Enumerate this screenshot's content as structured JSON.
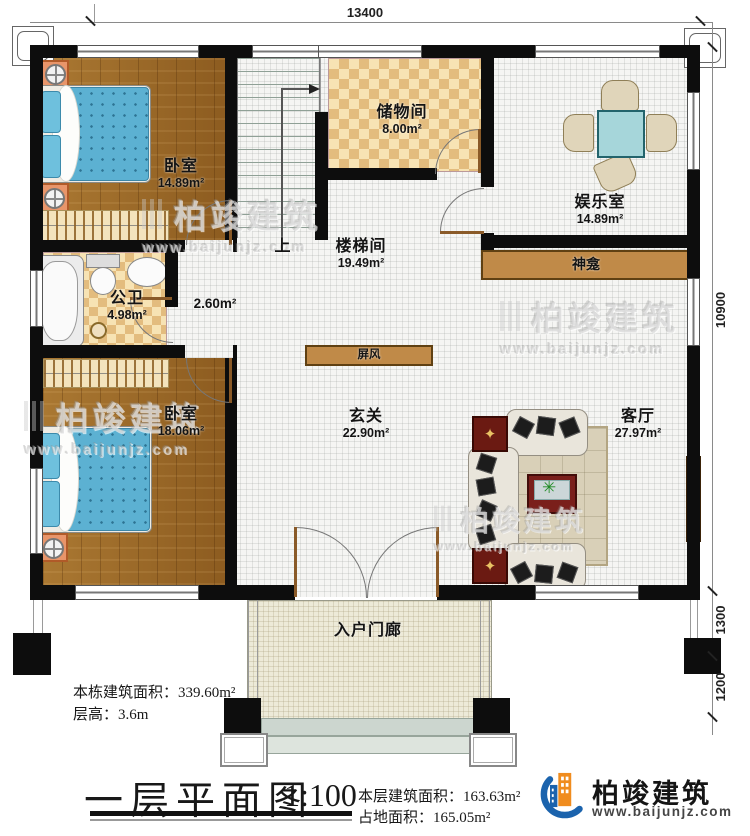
{
  "plan": {
    "dim_top": "13400",
    "dim_right_total": "10900",
    "dim_right_upper": "1300",
    "dim_right_lower": "1200",
    "rooms": {
      "bedroom1": {
        "name": "卧室",
        "area": "14.89m²"
      },
      "storage": {
        "name": "储物间",
        "area": "8.00m²"
      },
      "entertainment": {
        "name": "娱乐室",
        "area": "14.89m²"
      },
      "stairwell": {
        "name": "楼梯间",
        "area": "19.49m²",
        "up": "上"
      },
      "bathroom": {
        "name": "公卫",
        "area": "4.98m²"
      },
      "hall_small": {
        "area": "2.60m²"
      },
      "bedroom2": {
        "name": "卧室",
        "area": "18.06m²"
      },
      "foyer": {
        "name": "玄关",
        "area": "22.90m²"
      },
      "living": {
        "name": "客厅",
        "area": "27.97m²"
      },
      "porch": {
        "name": "入户门廊"
      }
    },
    "fixtures": {
      "shrine": "神龛",
      "screen": "屏风"
    }
  },
  "notes": {
    "building_total_label": "本栋建筑面积：",
    "building_total_value": "339.60m²",
    "floor_height_label": "层高：",
    "floor_height_value": "3.6m"
  },
  "titleblock": {
    "title": "一层平面图",
    "scale": "1:100",
    "floor_area_label": "本层建筑面积：",
    "floor_area_value": "163.63m²",
    "footprint_label": "占地面积：",
    "footprint_value": "165.05m²"
  },
  "brand": {
    "name": "柏竣建筑",
    "url": "www.baijunjz.com"
  },
  "watermark": {
    "brand": "柏竣建筑",
    "url": "www.baijunjz.com"
  },
  "colors": {
    "wall": "#0d0d0d",
    "wood": "#a2702c",
    "tile": "#f7e3b4",
    "shrine": "#c08a48",
    "accent_blue": "#1b63ad",
    "accent_orange": "#f08c1e"
  }
}
